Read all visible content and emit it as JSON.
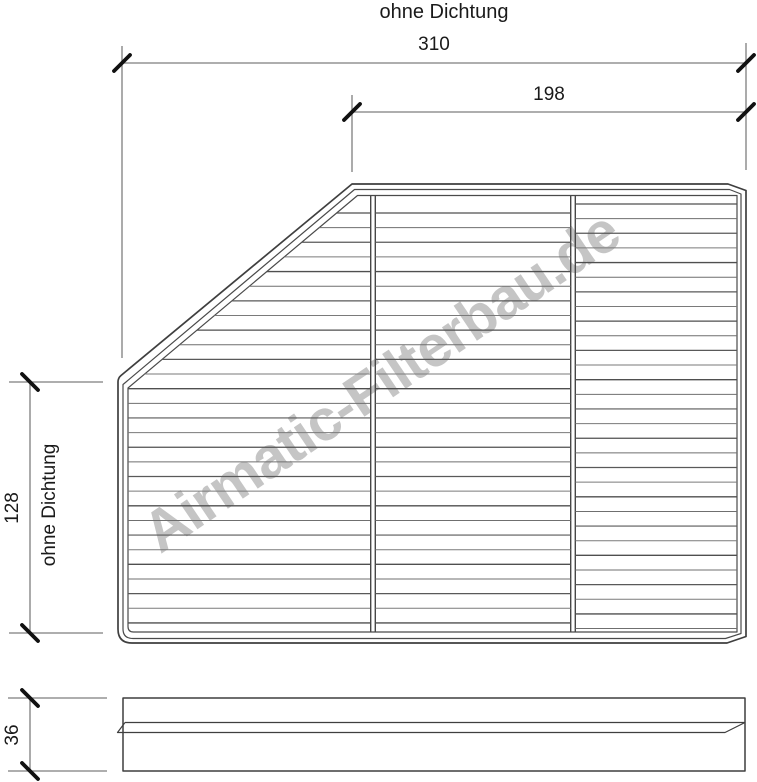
{
  "title": "ohne Dichtung",
  "watermark": "Airmatic-Filterbau.de",
  "main_view": {
    "dim_width_total": "310",
    "dim_width_top": "198",
    "dim_height": "128",
    "dim_height_label": "ohne Dichtung"
  },
  "side_view": {
    "dim_depth": "36"
  },
  "colors": {
    "outline": "#3f3f3f",
    "pleat": "#5f5f5f",
    "dimension_line": "#7e7e7e",
    "tick": "#111111",
    "text": "#1a1a1a",
    "watermark": "#c5c5c5",
    "background": "#ffffff"
  }
}
